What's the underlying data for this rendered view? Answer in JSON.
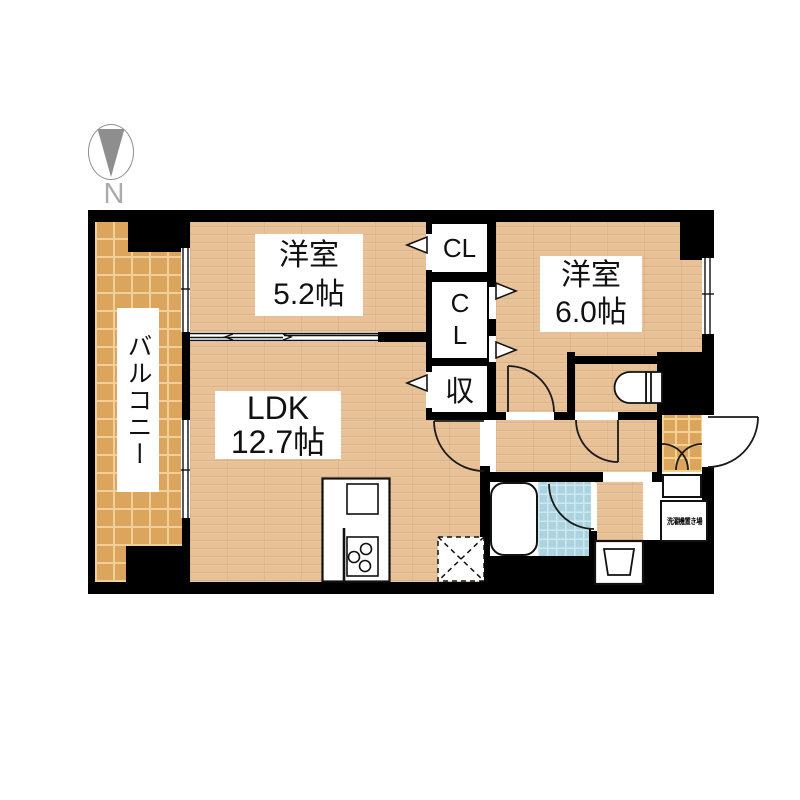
{
  "compass": {
    "north_label": "N"
  },
  "rooms": {
    "balcony": {
      "label": "バルコニー"
    },
    "western_room_1": {
      "name": "洋室",
      "size": "5.2帖"
    },
    "western_room_2": {
      "name": "洋室",
      "size": "6.0帖"
    },
    "ldk": {
      "name": "LDK",
      "size": "12.7帖"
    },
    "closet_1": {
      "label": "CL"
    },
    "closet_2": {
      "label": "CL"
    },
    "storage": {
      "label": "収"
    },
    "refrigerator_space": {
      "label": "冷"
    },
    "laundry_space": {
      "label": "洗濯機置き場"
    }
  },
  "colors": {
    "wall": "#000000",
    "wood_floor": "#e8c196",
    "balcony_tile": "#dca55e",
    "bath_tile": "#abd3e0",
    "compass_gray": "#8e8e8e"
  }
}
